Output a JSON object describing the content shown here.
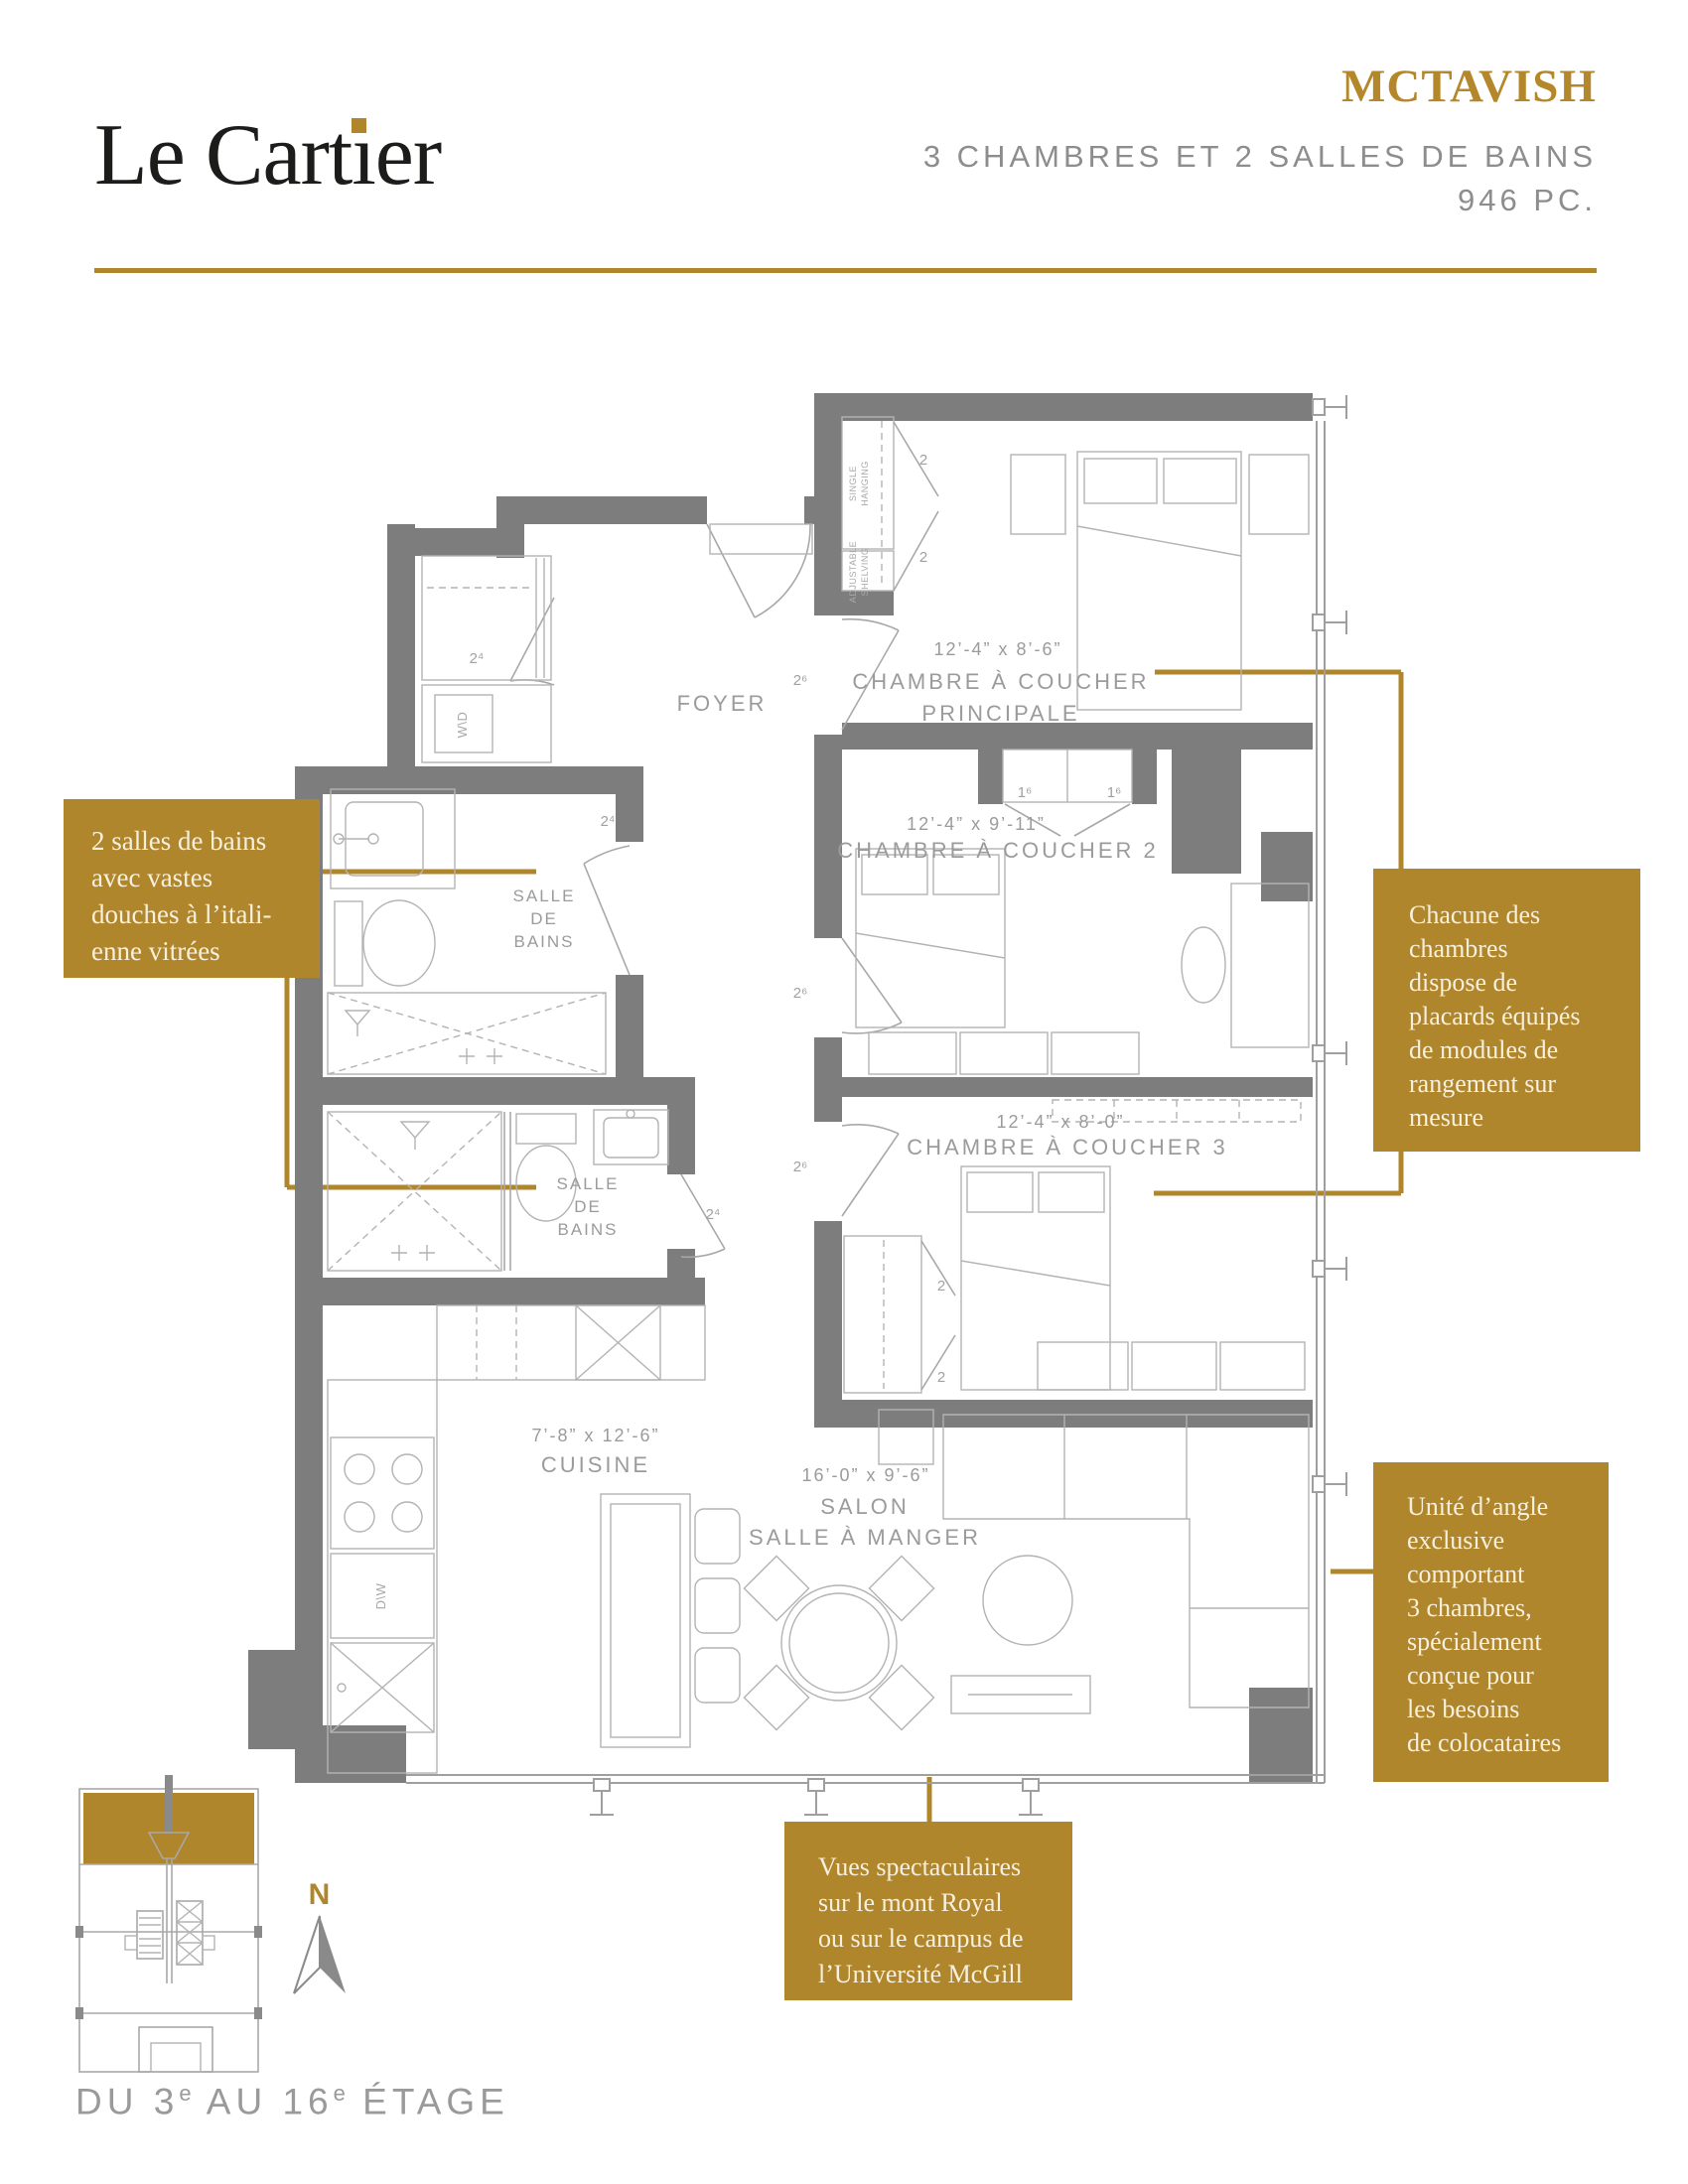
{
  "colors": {
    "gold": "#B0862C",
    "wall_gray": "#7D7D7D",
    "line_gray": "#A8A8A8",
    "label_gray": "#9B9B9B",
    "header_gray": "#8D8D8D"
  },
  "header": {
    "logo_1": "Le Cart",
    "logo_i": "ı",
    "logo_2": "er",
    "unit_name": "MCTAVISH",
    "subtitle": "3 CHAMBRES ET 2 SALLES DE BAINS",
    "area": "946 PC."
  },
  "callouts": {
    "bathrooms": "2 salles de bains\navec vastes\ndouches à l’itali-\nenne vitrées",
    "closets": "Chacune des\nchambres\ndispose de\nplacards équipés\nde modules de\nrangement sur\nmesure",
    "corner": "Unité d’angle\nexclusive\ncomportant\n3 chambres,\nspécialement\nconçue pour\nles besoins\nde colocataires",
    "views": "Vues spectaculaires\nsur le mont Royal\nou sur le campus de\nl’Université McGill"
  },
  "rooms": {
    "foyer": "FOYER",
    "master_dims": "12’-4” x 8’-6”",
    "master_name_1": "CHAMBRE À COUCHER",
    "master_name_2": "PRINCIPALE",
    "bedroom2_dims": "12’-4” x 9’-11”",
    "bedroom2_name": "CHAMBRE À COUCHER 2",
    "bedroom3_dims": "12’-4” x 8’-0”",
    "bedroom3_name": "CHAMBRE À COUCHER 3",
    "kitchen_dims": "7’-8” x 12’-6”",
    "kitchen_name": "CUISINE",
    "salon_dims": "16’-0” x 9’-6”",
    "salon_name_1": "SALON",
    "salon_name_2": "SALLE À MANGER",
    "bath_1": "SALLE",
    "bath_2": "DE",
    "bath_3": "BAINS"
  },
  "plan": {
    "door_2_4": "2⁴",
    "door_2_6": "2⁶",
    "door_1_6": "1⁶",
    "door_2": "2",
    "closet_single_1": "SINGLE",
    "closet_single_2": "HANGING",
    "closet_adj_1": "ADJUSTABLE",
    "closet_adj_2": "SHELVING",
    "washer": "W\\D",
    "dishwasher": "D\\W"
  },
  "footer": {
    "caption_1": "DU 3",
    "caption_sup_1": "e",
    "caption_2": " AU 16",
    "caption_sup_2": "e",
    "caption_3": " ÉTAGE",
    "north": "N"
  }
}
